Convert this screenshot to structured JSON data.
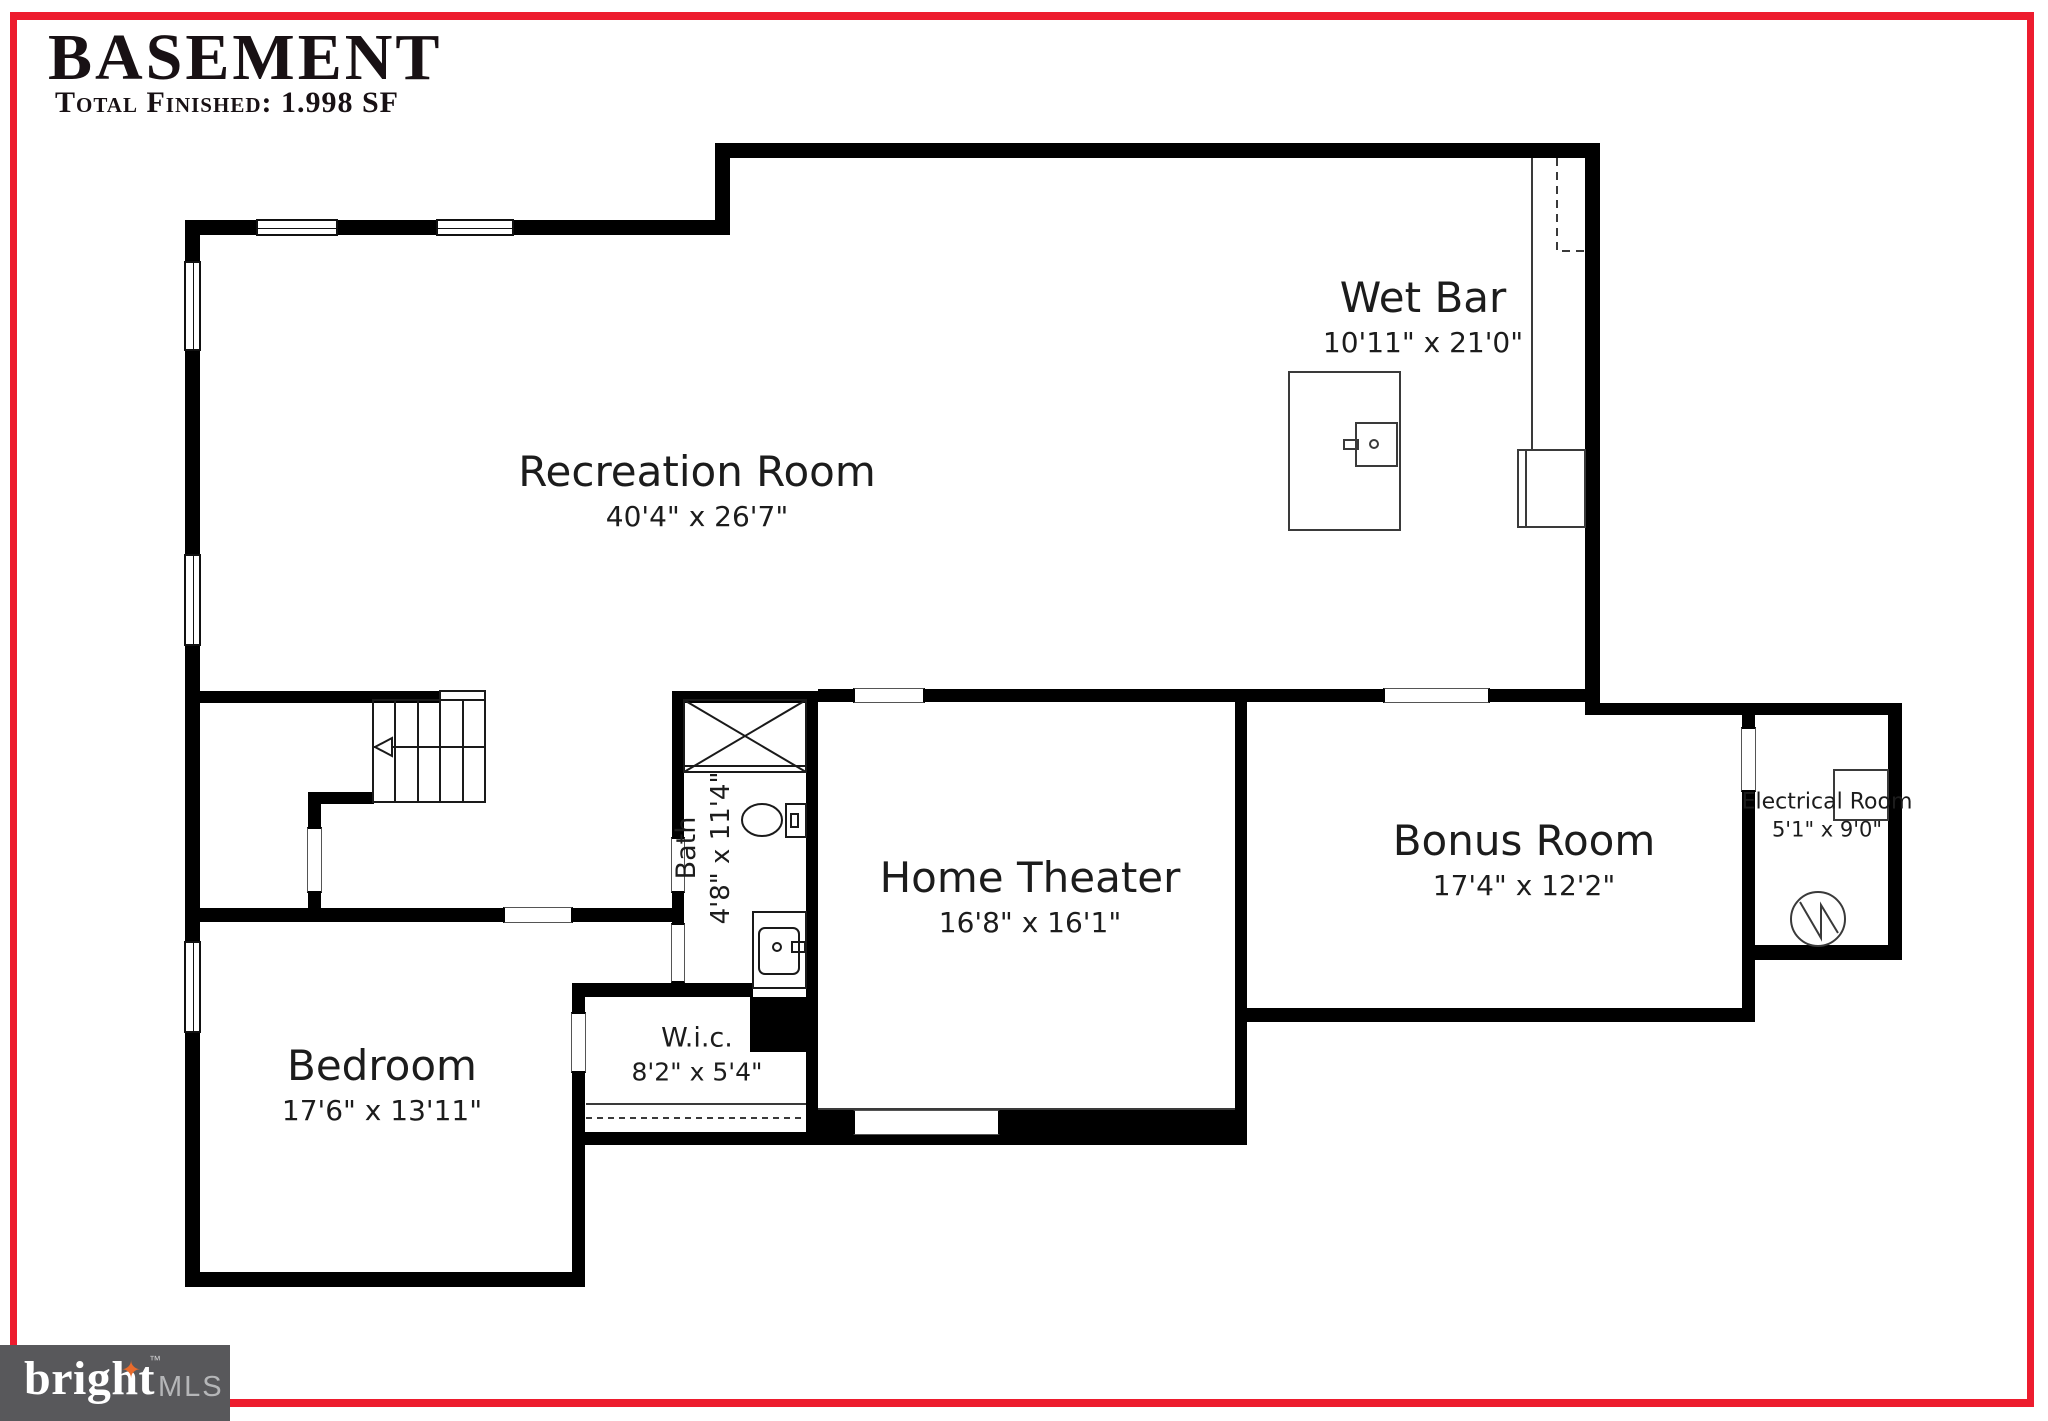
{
  "title": {
    "heading": "BASEMENT",
    "subtitle": "Total Finished: 1.998 SF"
  },
  "rooms": {
    "recreation": {
      "name": "Recreation Room",
      "dims": "40'4\" x 26'7\""
    },
    "wet_bar": {
      "name": "Wet Bar",
      "dims": "10'11\" x 21'0\""
    },
    "home_theater": {
      "name": "Home Theater",
      "dims": "16'8\" x 16'1\""
    },
    "bonus": {
      "name": "Bonus Room",
      "dims": "17'4\" x 12'2\""
    },
    "electrical": {
      "name": "Electrical Room",
      "dims": "5'1\" x 9'0\""
    },
    "bedroom": {
      "name": "Bedroom",
      "dims": "17'6\" x 13'11\""
    },
    "wic": {
      "name": "W.i.c.",
      "dims": "8'2\" x 5'4\""
    },
    "bath": {
      "name": "Bath",
      "dims": "4'8\" x 11'4\""
    }
  },
  "logo": {
    "brand": "bright",
    "suffix": "MLS",
    "tm": "™",
    "spark_glyph": "✦"
  },
  "colors": {
    "wall": "#000000",
    "accent_red": "#ed1c2e",
    "logo_bg": "#58585b",
    "logo_orange": "#e96b2c",
    "logo_text": "#ffffff",
    "logo_suffix": "#b5b6b8"
  }
}
